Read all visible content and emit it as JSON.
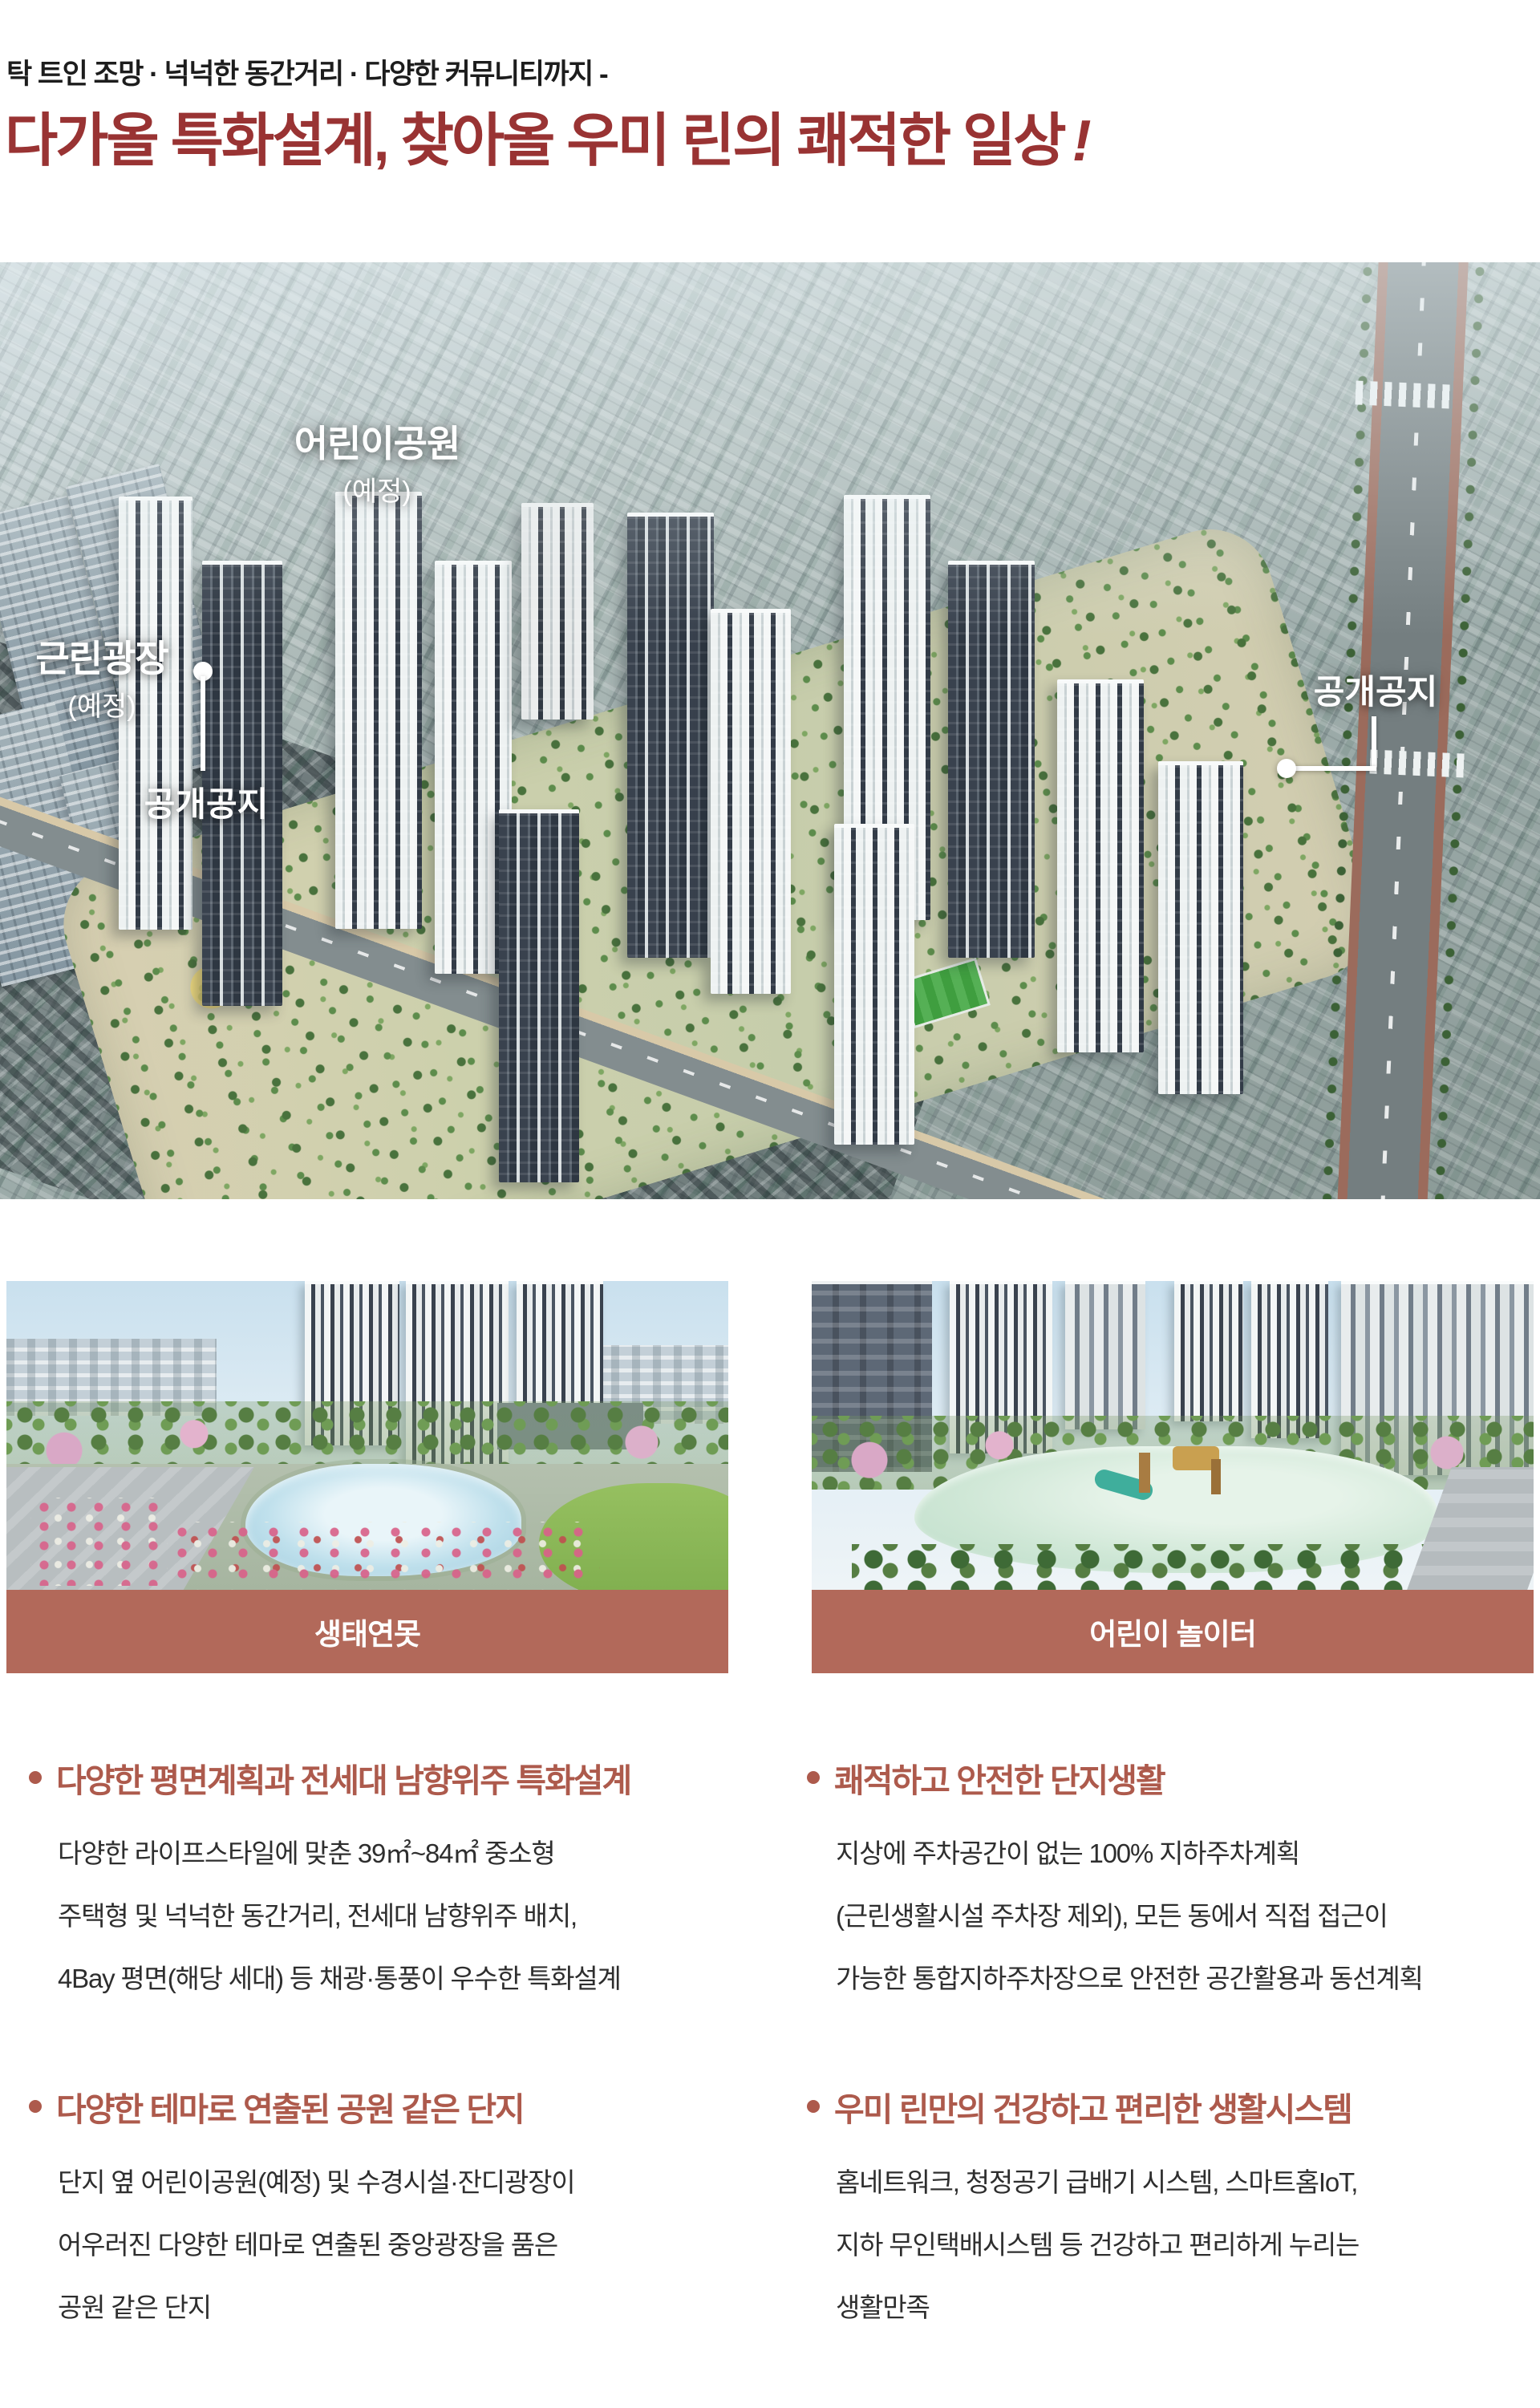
{
  "header": {
    "eyebrow": "탁 트인 조망 · 넉넉한 동간거리 · 다양한 커뮤니티까지 -",
    "title": "다가올 특화설계, 찾아올 우미 린의 쾌적한 일상",
    "title_bang": "!"
  },
  "colors": {
    "title_red": "#993333",
    "feature_heading": "#ad5a4c",
    "caption_bar": "#b2695a"
  },
  "aerial": {
    "labels": {
      "children_park": {
        "title": "어린이공원",
        "sub": "(예정)"
      },
      "plaza": {
        "title": "근린광장",
        "sub": "(예정)"
      },
      "open_space_left": "공개공지",
      "open_space_right": "공개공지"
    }
  },
  "photos": [
    {
      "caption": "생태연못"
    },
    {
      "caption": "어린이 놀이터"
    }
  ],
  "features": [
    {
      "heading": "다양한 평면계획과 전세대 남향위주 특화설계",
      "lines": [
        "다양한 라이프스타일에 맞춘 39㎡~84㎡ 중소형",
        "주택형 및 넉넉한 동간거리, 전세대 남향위주 배치,",
        "4Bay 평면(해당 세대) 등 채광·통풍이 우수한 특화설계"
      ]
    },
    {
      "heading": "쾌적하고 안전한 단지생활",
      "lines": [
        "지상에 주차공간이 없는 100% 지하주차계획",
        "(근린생활시설 주차장 제외), 모든 동에서 직접 접근이",
        "가능한 통합지하주차장으로 안전한 공간활용과 동선계획"
      ]
    },
    {
      "heading": "다양한 테마로 연출된 공원 같은 단지",
      "lines": [
        "단지 옆 어린이공원(예정) 및 수경시설·잔디광장이",
        "어우러진 다양한 테마로 연출된 중앙광장을 품은",
        "공원 같은 단지"
      ]
    },
    {
      "heading": "우미 린만의 건강하고 편리한 생활시스템",
      "lines": [
        "홈네트워크, 청정공기 급배기 시스템, 스마트홈IoT,",
        "지하 무인택배시스템 등 건강하고 편리하게 누리는",
        "생활만족"
      ]
    }
  ]
}
